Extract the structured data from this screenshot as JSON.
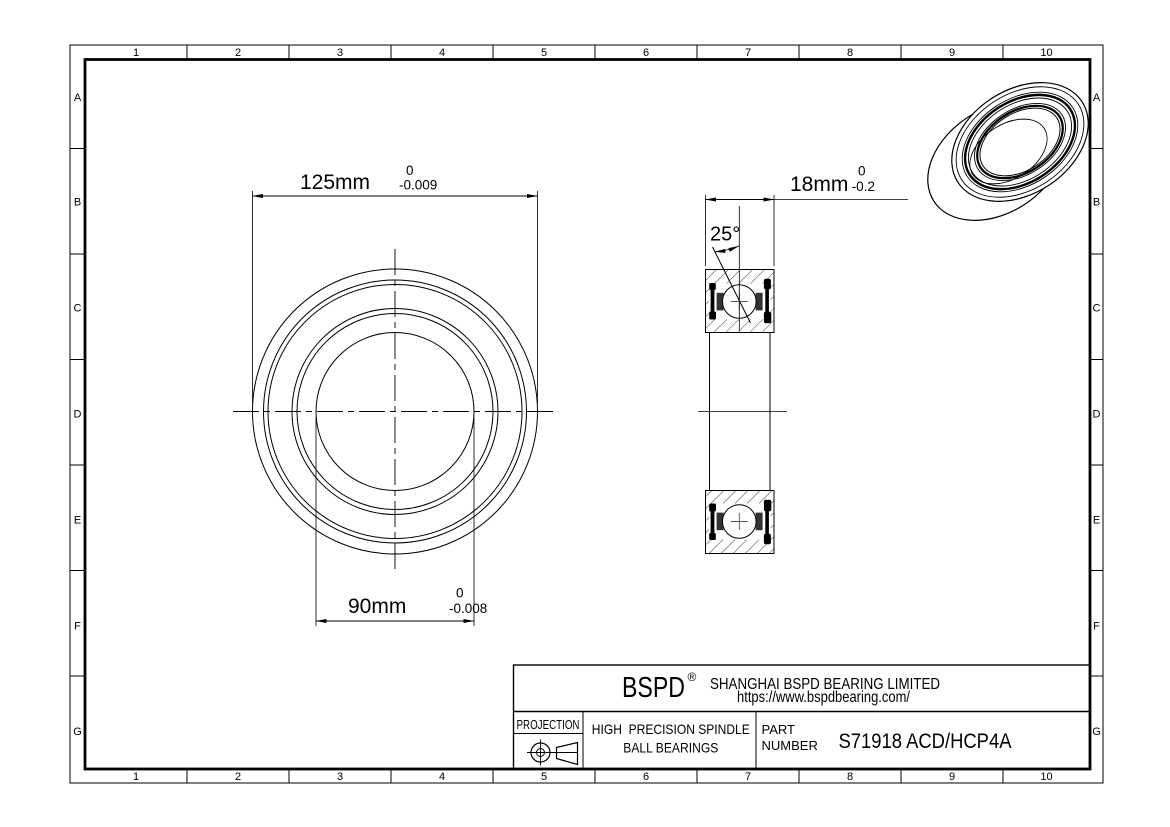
{
  "grid": {
    "columns": [
      "1",
      "2",
      "3",
      "4",
      "5",
      "6",
      "7",
      "8",
      "9",
      "10"
    ],
    "rows": [
      "A",
      "B",
      "C",
      "D",
      "E",
      "F",
      "G"
    ]
  },
  "dimensions": {
    "outer_diameter": {
      "value": "125mm",
      "tol_upper": "0",
      "tol_lower": "-0.009"
    },
    "bore_diameter": {
      "value": "90mm",
      "tol_upper": "0",
      "tol_lower": "-0.008"
    },
    "width": {
      "value": "18mm",
      "tol_upper": "0",
      "tol_lower": "-0.2"
    },
    "contact_angle": {
      "value": "25°"
    }
  },
  "title_block": {
    "logo": "BSPD",
    "registered_mark": "®",
    "company_name": "SHANGHAI BSPD BEARING LIMITED",
    "website": "https://www.bspdbearing.com/",
    "projection_label": "PROJECTION",
    "product_type_line1": "HIGH  PRECISION SPINDLE",
    "product_type_line2": "BALL BEARINGS",
    "part_label_line1": "PART",
    "part_label_line2": "NUMBER",
    "part_number": "S71918 ACD/HCP4A"
  },
  "colors": {
    "line": "#000000",
    "background": "#ffffff",
    "seal_fill": "#000000",
    "shoulder_fill": "#333333"
  }
}
